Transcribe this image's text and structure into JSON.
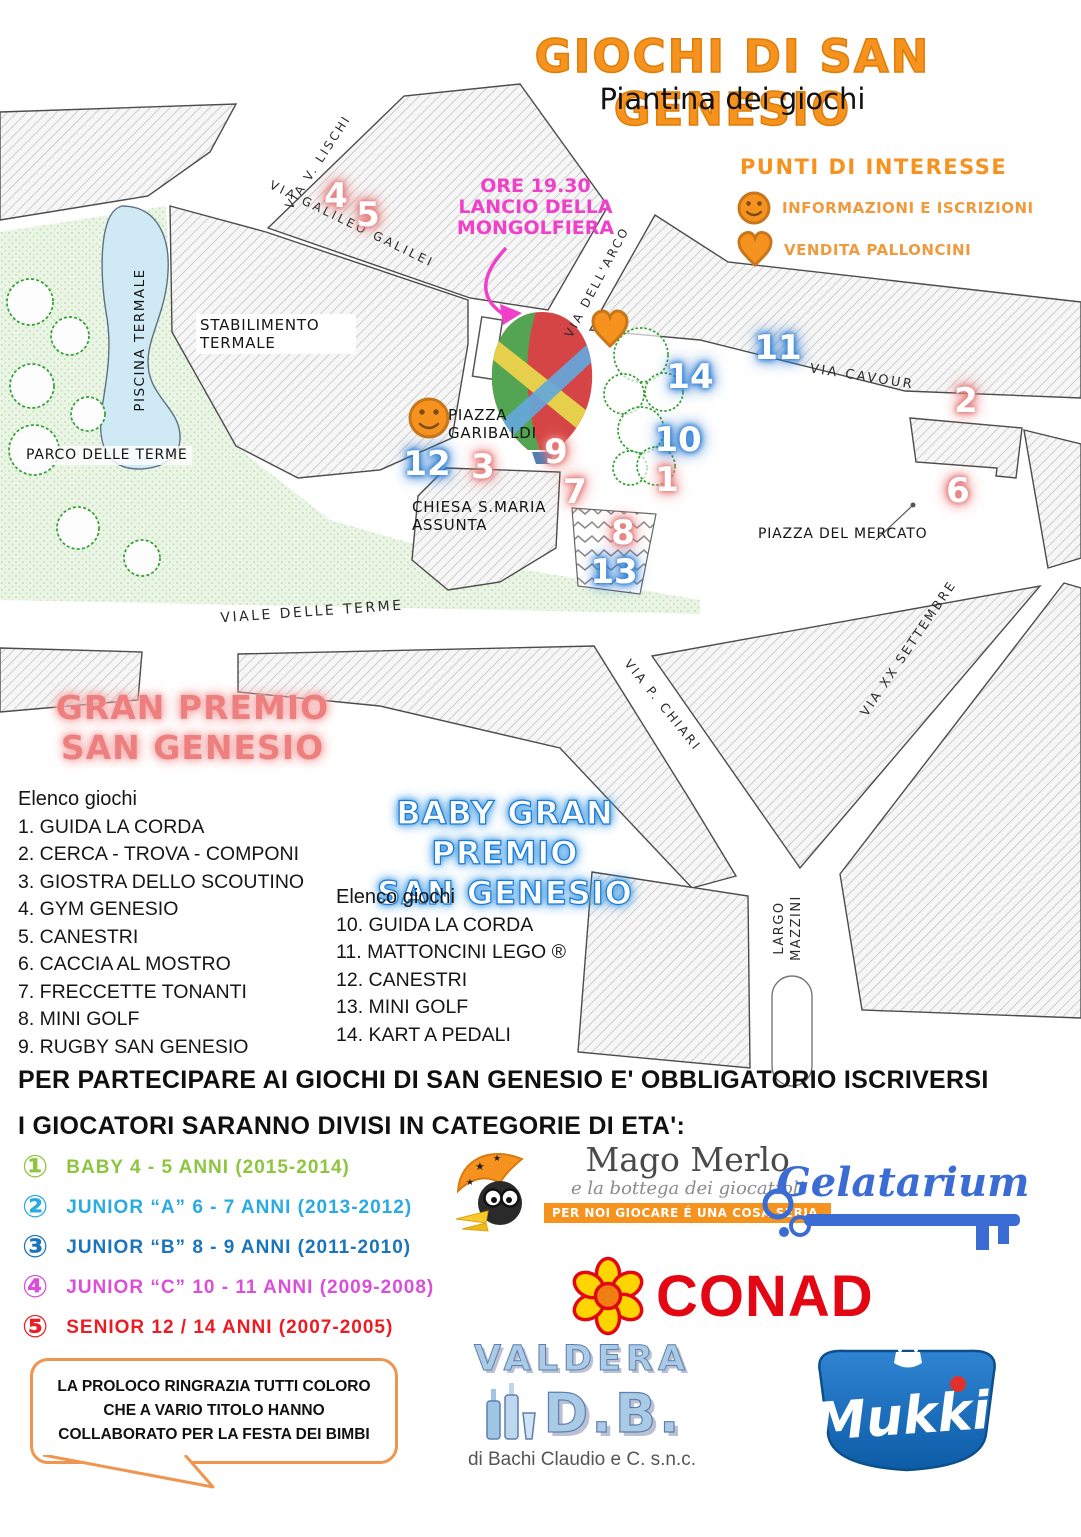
{
  "header": {
    "title": "GIOCHI DI SAN GENESIO",
    "subtitle": "Piantina dei giochi"
  },
  "legend": {
    "title": "PUNTI DI INTERESSE",
    "items": [
      {
        "icon": "smiley-icon",
        "label": "INFORMAZIONI E ISCRIZIONI"
      },
      {
        "icon": "heart-icon",
        "label": "VENDITA PALLONCINI"
      }
    ]
  },
  "map": {
    "annotation": [
      "ORE 19.30",
      "LANCIO DELLA",
      "MONGOLFIERA"
    ],
    "streets": [
      "VIA V. LISCHI",
      "VIA GALILEO GALILEI",
      "VIA DELL'ARCO",
      "VIA CAVOUR",
      "VIALE DELLE TERME",
      "VIA P. CHIARI",
      "VIA XX SETTEMBRE",
      "LARGO MAZZINI"
    ],
    "places": [
      "PISCINA TERMALE",
      "STABILIMENTO TERMALE",
      "PARCO DELLE TERME",
      "PIAZZA GARIBALDI",
      "CHIESA S.MARIA ASSUNTA",
      "PIAZZA DEL MERCATO"
    ],
    "markers": [
      {
        "n": "1",
        "group": "gran-premio"
      },
      {
        "n": "2",
        "group": "gran-premio"
      },
      {
        "n": "3",
        "group": "gran-premio"
      },
      {
        "n": "4",
        "group": "gran-premio"
      },
      {
        "n": "5",
        "group": "gran-premio"
      },
      {
        "n": "6",
        "group": "gran-premio"
      },
      {
        "n": "7",
        "group": "gran-premio"
      },
      {
        "n": "8",
        "group": "gran-premio"
      },
      {
        "n": "9",
        "group": "gran-premio"
      },
      {
        "n": "10",
        "group": "baby"
      },
      {
        "n": "11",
        "group": "baby"
      },
      {
        "n": "12",
        "group": "baby"
      },
      {
        "n": "13",
        "group": "baby"
      },
      {
        "n": "14",
        "group": "baby"
      }
    ]
  },
  "gran_premio": {
    "title_line1": "GRAN PREMIO",
    "title_line2": "SAN GENESIO",
    "list_header": "Elenco giochi",
    "items": [
      "1. GUIDA LA CORDA",
      "2. CERCA - TROVA - COMPONI",
      "3. GIOSTRA DELLO SCOUTINO",
      "4. GYM GENESIO",
      "5. CANESTRI",
      "6. CACCIA AL MOSTRO",
      "7. FRECCETTE TONANTI",
      "8. MINI GOLF",
      "9. RUGBY SAN GENESIO"
    ]
  },
  "baby_gran_premio": {
    "title_line1": "BABY GRAN PREMIO",
    "title_line2": "SAN GENESIO",
    "list_header": "Elenco giochi",
    "items": [
      "10. GUIDA LA CORDA",
      "11. MATTONCINI LEGO ®",
      "12. CANESTRI",
      "13. MINI GOLF",
      "14. KART A PEDALI"
    ]
  },
  "info": {
    "line1": "PER PARTECIPARE AI GIOCHI DI SAN GENESIO E' OBBLIGATORIO ISCRIVERSI",
    "line2": "I GIOCATORI SARANNO DIVISI IN CATEGORIE DI ETA':"
  },
  "categories": [
    {
      "num": "①",
      "label": "BABY 4 - 5 ANNI (2015-2014)",
      "color": "#8CC63E"
    },
    {
      "num": "②",
      "label": "JUNIOR “A” 6 - 7 ANNI (2013-2012)",
      "color": "#29ABE2"
    },
    {
      "num": "③",
      "label": "JUNIOR “B” 8 - 9 ANNI (2011-2010)",
      "color": "#1B75BC"
    },
    {
      "num": "④",
      "label": "JUNIOR “C” 10 - 11 ANNI (2009-2008)",
      "color": "#D94FD9"
    },
    {
      "num": "⑤",
      "label": "SENIOR 12 / 14 ANNI (2007-2005)",
      "color": "#EC1C24"
    }
  ],
  "sponsors": {
    "mago_merlo": {
      "name": "Mago Merlo",
      "tagline": "e la bottega dei giocattoli",
      "banner": "PER NOI GIOCARE É UNA COSA SERIA."
    },
    "gelatarium": {
      "name": "Gelatarium"
    },
    "conad": {
      "name": "CONAD"
    },
    "valdera": {
      "line1": "VALDERA",
      "line2": "D.B.",
      "subtext": "di Bachi Claudio e C. s.n.c."
    },
    "mukki": {
      "name": "Mukki"
    }
  },
  "thanks": {
    "text": "LA PROLOCO RINGRAZIA TUTTI COLORO CHE A VARIO TITOLO HANNO COLLABORATO PER LA FESTA DEI BIMBI"
  },
  "colors": {
    "accent_orange": "#F6921E",
    "marker_gran_premio": "#E87C7C",
    "marker_baby": "#2D7FD6",
    "annotation_pink": "#F03FC8",
    "gran_premio_title": "#EE7F7F",
    "baby_title_outline": "#1B7AD2",
    "category_colors": [
      "#8CC63E",
      "#29ABE2",
      "#1B75BC",
      "#D94FD9",
      "#EC1C24"
    ]
  }
}
